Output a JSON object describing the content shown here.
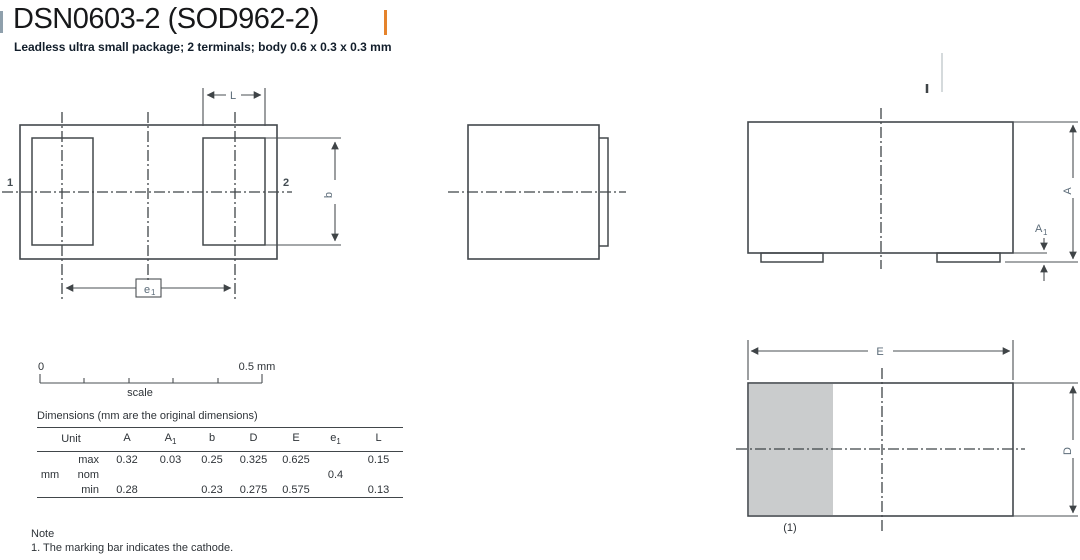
{
  "header": {
    "title": "DSN0603-2 (SOD962-2)",
    "subtitle": "Leadless ultra small package; 2 terminals; body 0.6 x 0.3 x 0.3 mm"
  },
  "colors": {
    "accent_bar": "#e5832c",
    "marking_bar_gray": "#cacccd",
    "drawing_line": "#43484c",
    "dimension_label": "#5b6b78"
  },
  "drawings": {
    "bottom_view": {
      "pin1": "1",
      "pin2": "2",
      "dim_L": "L",
      "dim_b": "b",
      "dim_e_base": "e",
      "dim_e_sub": "1"
    },
    "front_view": {
      "dim_A": "A",
      "dim_A1_base": "A",
      "dim_A1_sub": "1"
    },
    "top_view": {
      "dim_E": "E",
      "dim_D": "D",
      "note_ref": "(1)"
    }
  },
  "scale_bar": {
    "start": "0",
    "end": "0.5 mm",
    "label": "scale"
  },
  "table": {
    "caption": "Dimensions (mm are the original dimensions)",
    "unit_header": "Unit",
    "unit": "mm",
    "columns": [
      {
        "base": "A",
        "sub": ""
      },
      {
        "base": "A",
        "sub": "1"
      },
      {
        "base": "b",
        "sub": ""
      },
      {
        "base": "D",
        "sub": ""
      },
      {
        "base": "E",
        "sub": ""
      },
      {
        "base": "e",
        "sub": "1"
      },
      {
        "base": "L",
        "sub": ""
      }
    ],
    "rows": [
      {
        "label": "max",
        "values": [
          "0.32",
          "0.03",
          "0.25",
          "0.325",
          "0.625",
          "",
          "0.15"
        ]
      },
      {
        "label": "nom",
        "values": [
          "",
          "",
          "",
          "",
          "",
          "0.4",
          ""
        ]
      },
      {
        "label": "min",
        "values": [
          "0.28",
          "",
          "0.23",
          "0.275",
          "0.575",
          "",
          "0.13"
        ]
      }
    ]
  },
  "note": {
    "heading": "Note",
    "item1": "1. The marking bar indicates the cathode."
  }
}
